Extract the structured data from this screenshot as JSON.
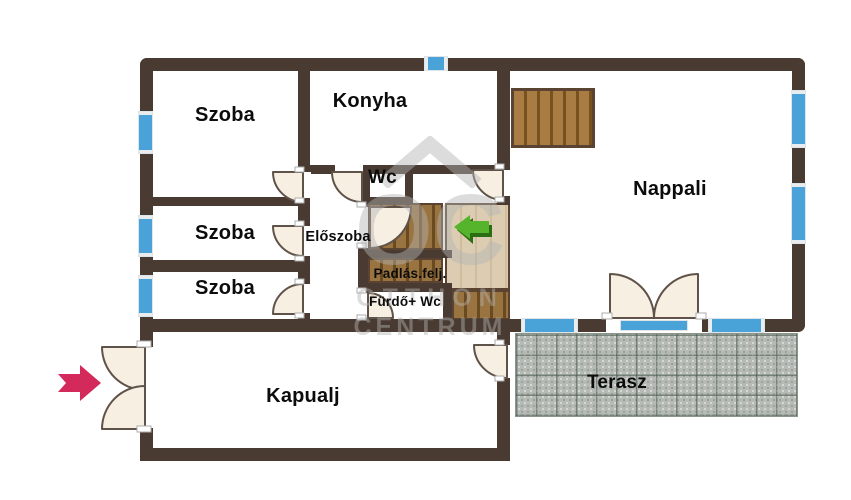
{
  "plan": {
    "title": "floor-plan",
    "rooms": [
      {
        "id": "szoba-1",
        "label": "Szoba"
      },
      {
        "id": "szoba-2",
        "label": "Szoba"
      },
      {
        "id": "szoba-3",
        "label": "Szoba"
      },
      {
        "id": "konyha",
        "label": "Konyha"
      },
      {
        "id": "wc",
        "label": "Wc"
      },
      {
        "id": "eloszoba",
        "label": "Előszoba"
      },
      {
        "id": "nappali",
        "label": "Nappali"
      },
      {
        "id": "padlas-feljaro",
        "label": "Padlás.felj."
      },
      {
        "id": "furdo-wc",
        "label": "Fürdő+ Wc"
      },
      {
        "id": "kapualj",
        "label": "Kapualj"
      },
      {
        "id": "terasz",
        "label": "Terasz"
      }
    ],
    "watermark": {
      "logo": "OC",
      "name_line1": "OTTHON",
      "name_line2": "CENTRUM"
    },
    "icons": {
      "entry_arrow": "red-arrow-right-icon",
      "attic_arrow": "green-arrow-left-icon",
      "roof": "roof-icon"
    },
    "colors": {
      "wall": "#4a3b32",
      "window_blue": "#4aa3d8",
      "door_leaf": "#f7efe2",
      "wood_dark": "#8a6434",
      "wood_light": "#dccdb2",
      "terrace_gray": "#b5bbb4",
      "arrow_green": "#55b42c",
      "arrow_red": "#d3295b",
      "watermark_gray": "#b3b3b3"
    }
  }
}
